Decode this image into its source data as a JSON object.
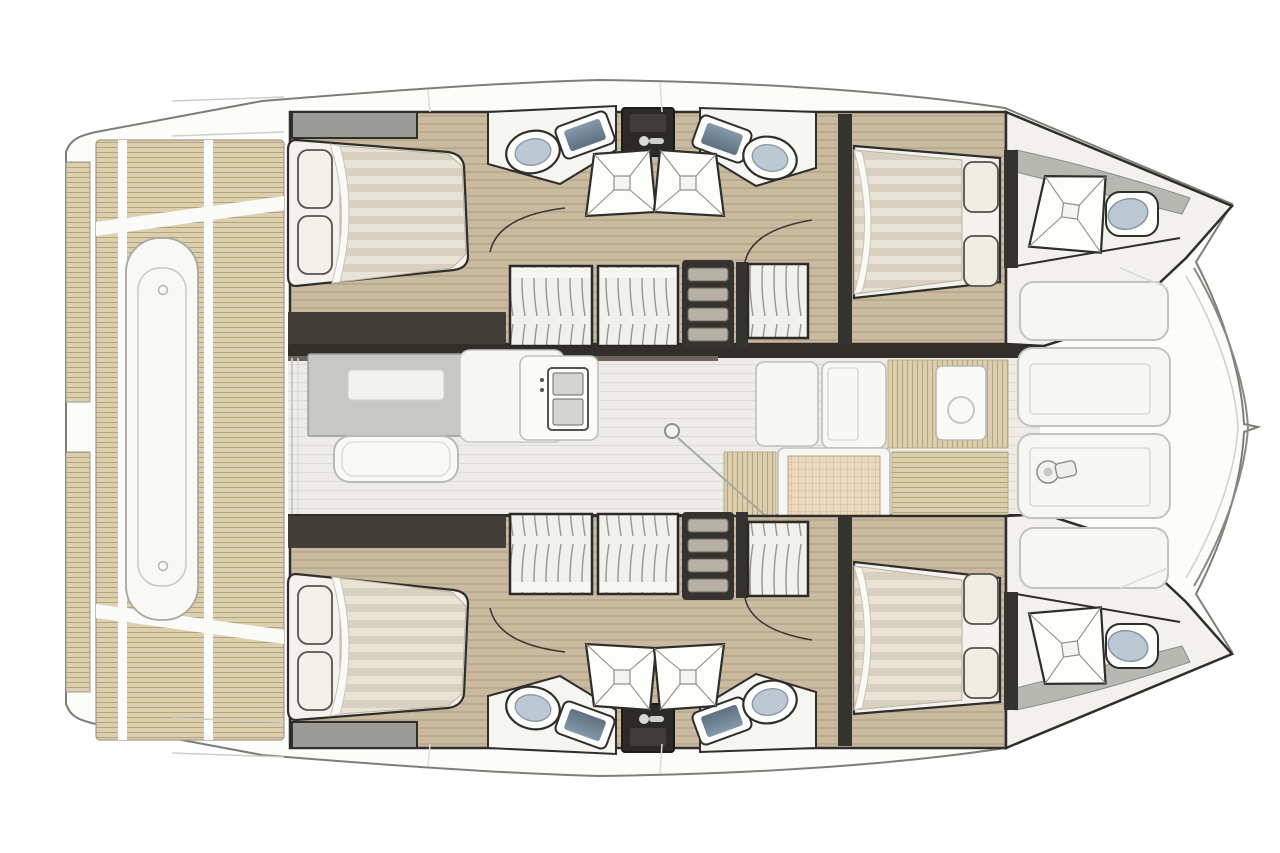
{
  "page": {
    "title": "Catamaran yacht floor plan — top-down deck and accommodation layout drawing (no visible text in image)"
  },
  "colors": {
    "canvas": "#ffffff",
    "body_fill": "#fcfcfb",
    "body_stroke": "#7e7e79",
    "outline": "#2f2e2b",
    "teak": "#dccfae",
    "teak_line": "#b5a37e",
    "wood": "#c9baa0",
    "wood_line": "#ab997b",
    "saloon_floor": "#edece8",
    "saloon_line": "#dedcd6",
    "wall_dark": "#322f2b",
    "wall_mid": "#4f4b45",
    "wall_brown": "#6e6459",
    "furniture_white": "#f7f7f4",
    "soft_stroke": "#c0c0ba",
    "table_gray": "#c7c7c5",
    "mattress_a": "#e9e3d6",
    "mattress_b": "#d9d1bf",
    "pillow": "#f2f0e9",
    "basin_top": "#8499aa",
    "basin_bottom": "#5c7082",
    "toilet_seat": "#bcc9d3",
    "wardrobe_line": "#96958e",
    "step_tread": "#b6b0a5",
    "grid_mat": "#ead9bd",
    "grid_line": "#c6ae87",
    "deck_band_gray": "#b8b8b3"
  },
  "areas": {
    "aft_deck": {
      "name": "Aft cockpit deck",
      "features": [
        "teak decking panels",
        "central lounge bench",
        "transom steps",
        "side swim platforms"
      ]
    },
    "saloon": {
      "name": "Saloon and galley",
      "features": [
        "dining table",
        "sofa bench",
        "galley counter with double sink",
        "mast step",
        "forward galley counters",
        "forward cockpit grid mat",
        "teak walkway"
      ]
    },
    "port_hull": {
      "name": "Port hull (top)",
      "features": [
        "aft double cabin with bed and pillows",
        "headboard shelf",
        "two washbasins",
        "vanity dresser",
        "two shower trays",
        "two toilets",
        "two wardrobes",
        "companionway steps",
        "forward double cabin",
        "forward head with shower and toilet",
        "bow tip"
      ]
    },
    "starboard_hull": {
      "name": "Starboard hull (bottom, mirror of port hull)",
      "features": [
        "aft double cabin with bed and pillows",
        "headboard shelf",
        "two washbasins",
        "vanity dresser",
        "two shower trays",
        "two toilets",
        "two wardrobes",
        "companionway steps",
        "forward double cabin",
        "forward head with shower and toilet",
        "bow tip"
      ]
    },
    "foredeck": {
      "name": "Foredeck lounge",
      "features": [
        "four sunpad cushions",
        "anchor windlass",
        "bowsprit tip",
        "forward crossbeam curve"
      ]
    }
  }
}
